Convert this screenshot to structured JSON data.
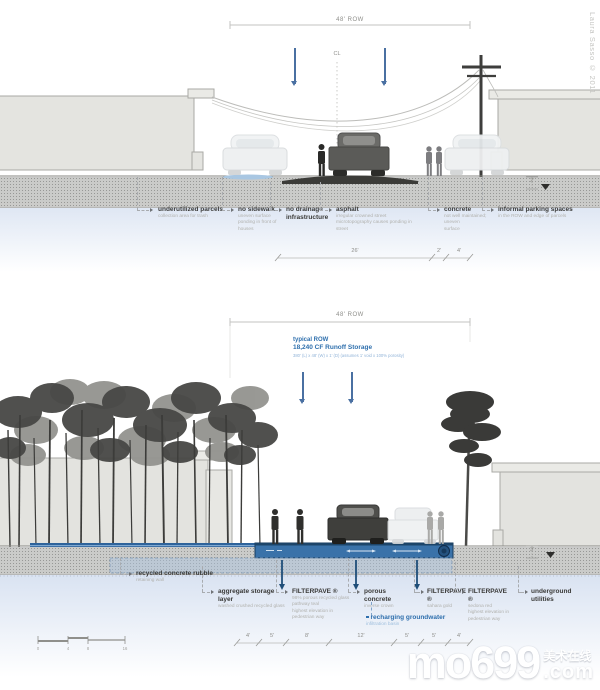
{
  "credit": "Laura Sasso © 2011",
  "watermark": {
    "brand": "mo699",
    "cjk": "美术在线",
    "tld": ".com"
  },
  "scalebar": {
    "t0": "0",
    "t1": "4",
    "t2": "8",
    "t3": "16"
  },
  "existing": {
    "row_dim": "48' ROW",
    "cl": "CL",
    "depth_dim": "2'",
    "dim_a": "26'",
    "dim_b": "2'",
    "dim_c": "4'",
    "callouts": [
      {
        "title": "underutilized parcels",
        "sub1": "collection area for trash"
      },
      {
        "title": "no sidewalk",
        "sub1": "uneven surface",
        "sub2": "ponding in front of houses"
      },
      {
        "title": "no drainage infrastructure"
      },
      {
        "title": "asphalt",
        "sub1": "irregular crowned street",
        "sub2": "microtopography causes ponding in street"
      },
      {
        "title": "concrete",
        "sub1": "not well maintained; uneven",
        "sub2": "surface"
      },
      {
        "title": "informal parking spaces",
        "sub1": "in the ROW and edge of parcels"
      }
    ]
  },
  "proposed": {
    "row_dim": "48' ROW",
    "storage_title": "typical ROW",
    "storage_value": "18,240 CF  Runoff Storage",
    "storage_note": "380' (L) x 48' (W) x 1' (D)  (assumes 1' void x 100% porosity)",
    "depth_dim": "3'",
    "dims": [
      "4'",
      "5'",
      "8'",
      "12'",
      "5'",
      "5'",
      "4'"
    ],
    "callouts": [
      {
        "title": "recycled concrete rubble",
        "sub1": "retaining wall"
      },
      {
        "title": "aggregate storage layer",
        "sub1": "washed crushed recycled glass"
      },
      {
        "title": "FILTERPAVE ®",
        "sub1": "98% porous recycled glass",
        "sub2": "pathway teal",
        "sub3": "highest elevation in pedestrian way"
      },
      {
        "title": "porous concrete",
        "sub1": "inverse crown"
      },
      {
        "title": "FILTERPAVE ®",
        "sub1": "sahara gold"
      },
      {
        "title": "FILTERPAVE ®",
        "sub1": "sedona red",
        "sub2": "highest elevation in pedestrian way"
      },
      {
        "title": "underground utilities"
      }
    ],
    "groundwater_title": "recharging groundwater",
    "groundwater_sub": "infiltration basin"
  }
}
